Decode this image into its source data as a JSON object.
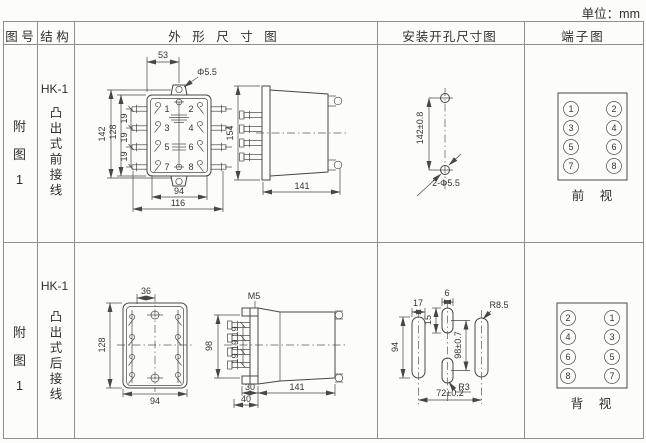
{
  "unit_label": "单位：mm",
  "header": {
    "fig_no": "图 号",
    "structure": "结 构",
    "outline": "外 形 尺 寸 图",
    "mounting": "安装开孔尺寸图",
    "terminal": "端子图"
  },
  "rows": [
    {
      "fig_no": [
        "附",
        "图",
        "1"
      ],
      "model": "HK-1",
      "structure": "凸出式前接线",
      "outline": {
        "dim_53": "53",
        "hole": "Φ5.5",
        "dim_142": "142",
        "dim_128": "128",
        "pitch": [
          "19",
          "19",
          "19"
        ],
        "terminals": [
          "1",
          "2",
          "3",
          "4",
          "5",
          "6",
          "7",
          "8"
        ],
        "dim_94": "94",
        "dim_116": "116",
        "dim_154": "154",
        "dim_141": "141"
      },
      "mounting": {
        "pitch": "142±0.8",
        "holes": "2-Φ5.5"
      },
      "terminal": {
        "left": [
          "1",
          "3",
          "5",
          "7"
        ],
        "right": [
          "2",
          "4",
          "6",
          "8"
        ],
        "view": "前 视"
      }
    },
    {
      "fig_no": [
        "附",
        "图",
        "1"
      ],
      "model": "HK-1",
      "structure": "凸出式后接线",
      "outline": {
        "dim_36": "36",
        "dim_128": "128",
        "dim_94": "94",
        "screw": "M5",
        "dim_98": "98",
        "pitch": [
          "19",
          "19",
          "19"
        ],
        "dim_30": "30",
        "dim_40": "40",
        "dim_141": "141"
      },
      "mounting": {
        "dim_17": "17",
        "dim_94": "94",
        "dim_6": "6",
        "dim_15": "15",
        "pitch": "98±0.7",
        "radius_right": "R8.5",
        "radius_mid": "R3",
        "span": "72±0.2"
      },
      "terminal": {
        "left": [
          "2",
          "4",
          "6",
          "8"
        ],
        "right": [
          "1",
          "3",
          "5",
          "7"
        ],
        "view": "背 视"
      }
    }
  ]
}
